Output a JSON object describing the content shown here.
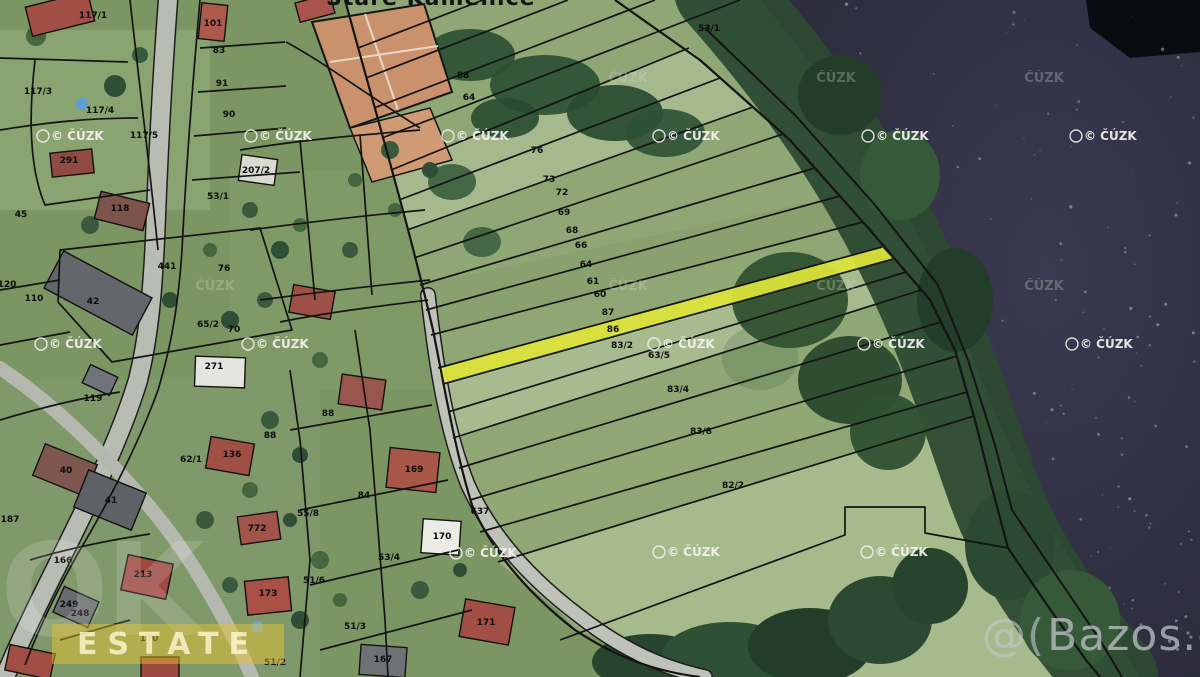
{
  "place_label": "Staré Kamenice",
  "watermarks": {
    "cadastre_copyright": "© ČÚZK",
    "cadastre_faint": "ČÚZK",
    "bazos_prefix": "@(",
    "bazos_text": "Bazos.cz",
    "agency_big": "OK",
    "agency_band": "ESTATE"
  },
  "map": {
    "highlighted_parcel": "87",
    "highlight_color": "#dde53a",
    "water_color": "#34334a",
    "copyright_positions": [
      {
        "x": 47,
        "y": 140
      },
      {
        "x": 255,
        "y": 140
      },
      {
        "x": 452,
        "y": 140
      },
      {
        "x": 663,
        "y": 140
      },
      {
        "x": 872,
        "y": 140
      },
      {
        "x": 1080,
        "y": 140
      },
      {
        "x": 45,
        "y": 348
      },
      {
        "x": 252,
        "y": 348
      },
      {
        "x": 658,
        "y": 348
      },
      {
        "x": 868,
        "y": 348
      },
      {
        "x": 1076,
        "y": 348
      },
      {
        "x": 460,
        "y": 557
      },
      {
        "x": 663,
        "y": 556
      },
      {
        "x": 871,
        "y": 556
      }
    ],
    "faint_positions": [
      {
        "x": 628,
        "y": 82
      },
      {
        "x": 836,
        "y": 82
      },
      {
        "x": 1044,
        "y": 82
      },
      {
        "x": 215,
        "y": 290
      },
      {
        "x": 628,
        "y": 290
      },
      {
        "x": 836,
        "y": 290
      },
      {
        "x": 1044,
        "y": 290
      }
    ],
    "parcel_labels": [
      {
        "text": "117/1",
        "x": 93,
        "y": 18
      },
      {
        "text": "101",
        "x": 213,
        "y": 26
      },
      {
        "text": "83",
        "x": 219,
        "y": 53
      },
      {
        "text": "91",
        "x": 222,
        "y": 86
      },
      {
        "text": "117/3",
        "x": 38,
        "y": 94
      },
      {
        "text": "117/4",
        "x": 100,
        "y": 113
      },
      {
        "text": "90",
        "x": 229,
        "y": 117
      },
      {
        "text": "117/5",
        "x": 144,
        "y": 138
      },
      {
        "text": "291",
        "x": 69,
        "y": 163
      },
      {
        "text": "207/2",
        "x": 256,
        "y": 173
      },
      {
        "text": "45",
        "x": 21,
        "y": 217
      },
      {
        "text": "118",
        "x": 120,
        "y": 211
      },
      {
        "text": "53/1",
        "x": 218,
        "y": 199
      },
      {
        "text": "441",
        "x": 167,
        "y": 269
      },
      {
        "text": "76",
        "x": 224,
        "y": 271
      },
      {
        "text": "120",
        "x": 7,
        "y": 287
      },
      {
        "text": "110",
        "x": 34,
        "y": 301
      },
      {
        "text": "42",
        "x": 93,
        "y": 304
      },
      {
        "text": "65/2",
        "x": 208,
        "y": 327
      },
      {
        "text": "70",
        "x": 234,
        "y": 332
      },
      {
        "text": "271",
        "x": 214,
        "y": 369
      },
      {
        "text": "119",
        "x": 93,
        "y": 401
      },
      {
        "text": "88",
        "x": 270,
        "y": 438
      },
      {
        "text": "136",
        "x": 232,
        "y": 457
      },
      {
        "text": "62/1",
        "x": 191,
        "y": 462
      },
      {
        "text": "40",
        "x": 66,
        "y": 473
      },
      {
        "text": "41",
        "x": 111,
        "y": 503
      },
      {
        "text": "187",
        "x": 10,
        "y": 522
      },
      {
        "text": "772",
        "x": 257,
        "y": 531
      },
      {
        "text": "166",
        "x": 63,
        "y": 563
      },
      {
        "text": "213",
        "x": 143,
        "y": 577
      },
      {
        "text": "249",
        "x": 69,
        "y": 607
      },
      {
        "text": "248",
        "x": 80,
        "y": 616
      },
      {
        "text": "173",
        "x": 268,
        "y": 596
      },
      {
        "text": "170",
        "x": 149,
        "y": 641
      },
      {
        "text": "51/2",
        "x": 275,
        "y": 665
      },
      {
        "text": "88",
        "x": 328,
        "y": 416
      },
      {
        "text": "169",
        "x": 414,
        "y": 472
      },
      {
        "text": "84",
        "x": 364,
        "y": 498
      },
      {
        "text": "55/8",
        "x": 308,
        "y": 516
      },
      {
        "text": "637",
        "x": 480,
        "y": 514
      },
      {
        "text": "170",
        "x": 442,
        "y": 539
      },
      {
        "text": "53/4",
        "x": 389,
        "y": 560
      },
      {
        "text": "51/6",
        "x": 314,
        "y": 583
      },
      {
        "text": "51/3",
        "x": 355,
        "y": 629
      },
      {
        "text": "171",
        "x": 486,
        "y": 625
      },
      {
        "text": "167",
        "x": 383,
        "y": 662
      },
      {
        "text": "53/1",
        "x": 709,
        "y": 31
      },
      {
        "text": "88",
        "x": 463,
        "y": 78
      },
      {
        "text": "64",
        "x": 469,
        "y": 100
      },
      {
        "text": "76",
        "x": 537,
        "y": 153
      },
      {
        "text": "73",
        "x": 549,
        "y": 182
      },
      {
        "text": "72",
        "x": 562,
        "y": 195
      },
      {
        "text": "69",
        "x": 564,
        "y": 215
      },
      {
        "text": "68",
        "x": 572,
        "y": 233
      },
      {
        "text": "66",
        "x": 581,
        "y": 248
      },
      {
        "text": "64",
        "x": 586,
        "y": 267
      },
      {
        "text": "61",
        "x": 593,
        "y": 284
      },
      {
        "text": "60",
        "x": 600,
        "y": 297
      },
      {
        "text": "87",
        "x": 608,
        "y": 315
      },
      {
        "text": "86",
        "x": 613,
        "y": 332
      },
      {
        "text": "83/2",
        "x": 622,
        "y": 348
      },
      {
        "text": "63/5",
        "x": 659,
        "y": 358
      },
      {
        "text": "83/4",
        "x": 678,
        "y": 392
      },
      {
        "text": "83/8",
        "x": 701,
        "y": 434
      },
      {
        "text": "82/2",
        "x": 733,
        "y": 488
      }
    ]
  }
}
